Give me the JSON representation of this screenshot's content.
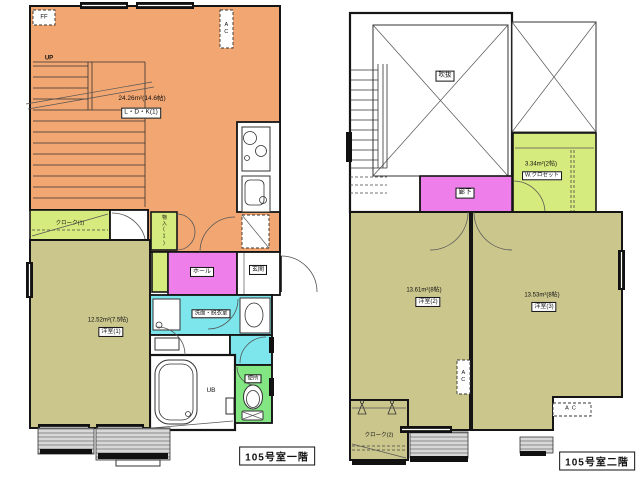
{
  "floor1": {
    "title": "105号室一階",
    "ldk_area": "24.26m²(14.6帖)",
    "ldk_name": "L・D・K(1)",
    "bedroom1_area": "12.52m²(7.5帖)",
    "bedroom1_name": "洋室(1)",
    "cloak1_name": "クローク(1)",
    "storage1_name": "物入(1)",
    "hall_name": "ホール",
    "genkan_name": "玄関",
    "washroom_name": "洗面・脱衣室",
    "toilet_name": "便所",
    "bath_name": "UB",
    "stair_label": "UP",
    "heater_label": "FF",
    "ac_label": "AC"
  },
  "floor2": {
    "title": "105号室二階",
    "void_name": "吹抜",
    "wcloset_area": "3.34m²(2帖)",
    "wcloset_name": "W.クロゼット",
    "corridor_name": "廊下",
    "bedroom2_area": "13.61m²(8帖)",
    "bedroom2_name": "洋室(2)",
    "bedroom3_area": "13.53m²(8帖)",
    "bedroom3_name": "洋室(3)",
    "cloak2_name": "クローク(2)",
    "ac_label": "AC"
  },
  "colors": {
    "ldk": "#F2A772",
    "bedroom": "#CBC68C",
    "closet": "#D6EB7D",
    "hall": "#EE7FEA",
    "washroom": "#7CE6EC",
    "toilet": "#82E682",
    "wall": "#151515"
  }
}
